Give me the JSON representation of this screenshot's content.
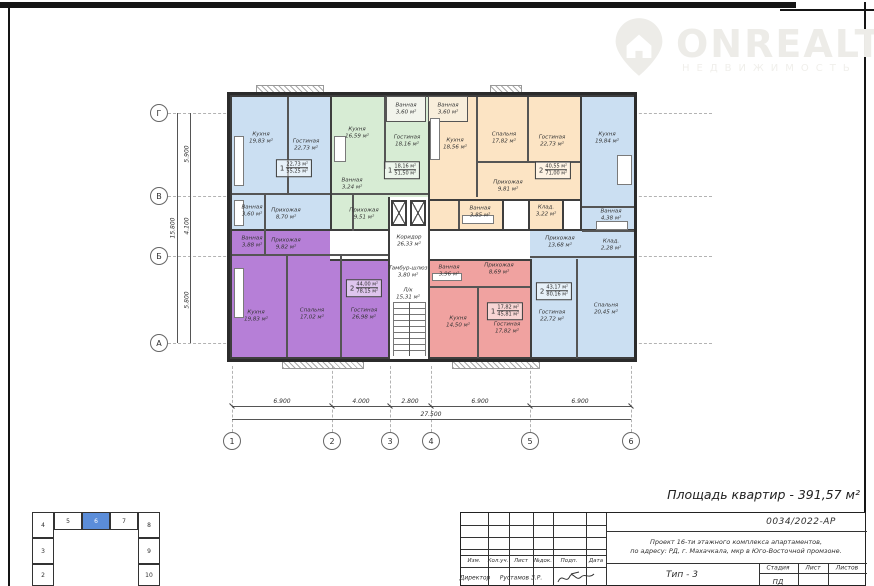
{
  "logo": {
    "name": "ONREALT",
    "subtitle": "НЕДВИЖИМОСТЬ"
  },
  "plan": {
    "area_title": "Площадь квартир - 391,57 м²",
    "axes": {
      "rows": [
        "Г",
        "В",
        "Б",
        "А"
      ],
      "cols": [
        "1",
        "2",
        "3",
        "4",
        "5",
        "6"
      ]
    },
    "dims": {
      "bottom": [
        "6.900",
        "4.000",
        "2.800",
        "6.900",
        "6.900"
      ],
      "bottom_total": "27.500",
      "left": [
        "5.900",
        "4.100",
        "5.800"
      ],
      "left_total": "15.800"
    },
    "apartments": [
      {
        "id": "apt-1",
        "color": "#cbdff2",
        "count": "1",
        "living": "22,73 м²",
        "total": "55,25 м²",
        "rooms": [
          "Кухня\n19,83 м²",
          "Гостиная\n22,73 м²",
          "Ванная\n3,60 м²",
          "Прихожая\n8,70 м²"
        ]
      },
      {
        "id": "apt-2",
        "color": "#d7ecd4",
        "count": "1",
        "living": "18,16 м²",
        "total": "51,50 м²",
        "rooms": [
          "Кухня\n16,59 м²",
          "Гостиная\n18,16 м²",
          "Ванная\n3,24 м²",
          "Прихожая\n9,51 м²"
        ]
      },
      {
        "id": "apt-3",
        "color": "#fce4c4",
        "count": "2",
        "living": "40,55 м²",
        "total": "71,00 м²",
        "rooms": [
          "Кухня\n18,56 м²",
          "Спальня\n17,82 м²",
          "Гостиная\n22,73 м²",
          "Прихожая\n9,81 м²",
          "Ванная\n3,85 м²",
          "Клад.\n3,22 м²"
        ]
      },
      {
        "id": "apt-4",
        "color": "#cbdff2",
        "count": "2",
        "living": "43,17 м²",
        "total": "80,16 м²",
        "rooms": [
          "Кухня\n19,84 м²",
          "Ванная\n4,38 м²",
          "Клад.\n2,28 м²",
          "Прихожая\n13,68 м²",
          "Гостиная\n22,72 м²",
          "Спальня\n20,45 м²"
        ]
      },
      {
        "id": "apt-5",
        "color": "#b67fd7",
        "count": "2",
        "living": "44,00 м²",
        "total": "78,15 м²",
        "rooms": [
          "Ванная\n3,88 м²",
          "Прихожая\n9,82 м²",
          "Кухня\n19,83 м²",
          "Спальня\n17,02 м²",
          "Гостиная\n26,98 м²"
        ]
      },
      {
        "id": "apt-6",
        "color": "#f0a2a0",
        "count": "1",
        "living": "17,82 м²",
        "total": "45,81 м²",
        "rooms": [
          "Ванная\n3,96 м²",
          "Прихожая\n8,69 м²",
          "Кухня\n14,50 м²",
          "Гостиная\n17,82 м²"
        ]
      }
    ],
    "common": [
      "Коридор\n26,33 м²",
      "Тамбур-шлюз\n3,80 м²",
      "Л/к\n15,31 м²"
    ],
    "extra": [
      "Ванная\n3,60 м²",
      "Ванная\n3,60 м²"
    ]
  },
  "titleblock": {
    "doc_number": "0034/2022-АР",
    "project_line1": "Проект 16-ти этажного комплекса апартаментов,",
    "project_line2": "по адресу: РД, г. Махачкала, мкр в Юго-Восточной промзоне.",
    "type_label": "Тип - 3",
    "cols": [
      "Изм.",
      "Кол.уч.",
      "Лист",
      "№док.",
      "Подп.",
      "Дата"
    ],
    "role": "Директор",
    "person": "Рустамов З.Р.",
    "stage_cols": [
      "Стадия",
      "Лист",
      "Листов"
    ],
    "stage_value": "ПД"
  },
  "keyplan": {
    "blocks": [
      "4",
      "5",
      "6",
      "7",
      "8",
      "3",
      "9",
      "2",
      "10"
    ],
    "active": "6"
  },
  "colors": {
    "blue": "#cbdff2",
    "green": "#d7ecd4",
    "orange": "#fce4c4",
    "purple": "#b67fd7",
    "red": "#f0a2a0",
    "keyplan_active": "#5b8dd9",
    "walls": "#3e3e3e",
    "logo": "#edece8"
  }
}
